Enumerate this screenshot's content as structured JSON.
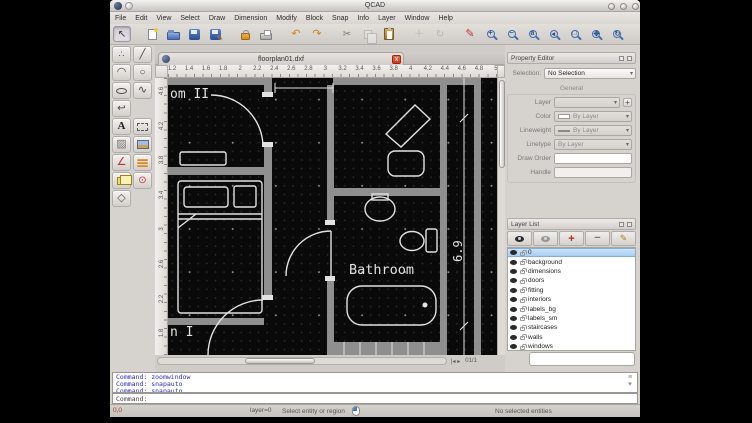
{
  "window": {
    "title": "QCAD"
  },
  "menu_bar": {
    "items": [
      "File",
      "Edit",
      "View",
      "Select",
      "Draw",
      "Dimension",
      "Modify",
      "Block",
      "Snap",
      "Info",
      "Layer",
      "Window",
      "Help"
    ]
  },
  "toolbar": {
    "buttons": [
      {
        "icon": "select-pointer",
        "pressed": true
      },
      {
        "icon": "sep"
      },
      {
        "icon": "new-file"
      },
      {
        "icon": "open-file"
      },
      {
        "icon": "save"
      },
      {
        "icon": "save-as"
      },
      {
        "icon": "sep"
      },
      {
        "icon": "secure-lock"
      },
      {
        "icon": "print"
      },
      {
        "icon": "sep"
      },
      {
        "icon": "undo"
      },
      {
        "icon": "redo"
      },
      {
        "icon": "sep"
      },
      {
        "icon": "cut"
      },
      {
        "icon": "copy",
        "disabled": true
      },
      {
        "icon": "paste"
      },
      {
        "icon": "sep"
      },
      {
        "icon": "move",
        "disabled": true
      },
      {
        "icon": "rotate",
        "disabled": true
      },
      {
        "icon": "sep"
      },
      {
        "icon": "pen-edit"
      },
      {
        "icon": "zoom-in"
      },
      {
        "icon": "zoom-out"
      },
      {
        "icon": "zoom-auto"
      },
      {
        "icon": "zoom-prev"
      },
      {
        "icon": "zoom-window"
      },
      {
        "icon": "zoom-pan"
      },
      {
        "icon": "zoom-refresh"
      }
    ]
  },
  "tool_palette": {
    "rows": [
      [
        "point-tool",
        "line-tool"
      ],
      [
        "arc-tool",
        "circle-tool"
      ],
      [
        "ellipse-tool",
        "spline-tool"
      ],
      [
        "polyline-tool"
      ],
      [
        "text-tool",
        "dimension-tool"
      ],
      [
        "hatch-tool",
        "image-tool"
      ],
      [
        "dimension-aligned-tool",
        "draw-order-tool"
      ],
      [
        "block-tool",
        "snap-tool"
      ],
      [
        "solid-tool"
      ]
    ]
  },
  "mdi": {
    "tab_title": "floorplan01.dxf",
    "close_glyph": "x",
    "page_indicator": "01/1"
  },
  "rulers": {
    "horizontal": [
      "1.2",
      "1.4",
      "1.6",
      "1.8",
      "2",
      "2.2",
      "2.4",
      "2.6",
      "2.8",
      "3",
      "3.2",
      "3.4",
      "3.6",
      "3.8",
      "4",
      "4.2",
      "4.4",
      "4.6",
      "4.8",
      "5"
    ],
    "vertical": [
      "4.6",
      "4.2",
      "3.8",
      "3.4",
      "3",
      "2.6",
      "2.2",
      "1.8"
    ]
  },
  "canvas": {
    "labels": {
      "room2_partial": "om II",
      "room1_partial": "n I",
      "bathroom": "Bathroom",
      "dimension": "6.9"
    }
  },
  "property_editor": {
    "title": "Property Editor",
    "selection_label": "Selection:",
    "selection_value": "No Selection",
    "group_general": "General",
    "layer_label": "Layer",
    "color_label": "Color",
    "color_value": "By Layer",
    "lineweight_label": "Lineweight",
    "lineweight_value": "By Layer",
    "linetype_label": "Linetype",
    "linetype_value": "By Layer",
    "draw_order_label": "Draw Order",
    "handle_label": "Handle",
    "add_layer_plus": "+"
  },
  "layer_list": {
    "title": "Layer List",
    "toolbar_icons": [
      "show-all-layers",
      "hide-all-layers",
      "add-layer",
      "remove-layer",
      "edit-layer"
    ],
    "layers": [
      "0",
      "background",
      "dimensions",
      "doors",
      "fitting",
      "interiors",
      "labels_bg",
      "labels_sm",
      "staircases",
      "walls",
      "windows"
    ],
    "selected_index": 0
  },
  "command": {
    "history": [
      "Command: zoomwindow",
      "Command: snapauto",
      "Command: snapauto"
    ],
    "prompt": "Command:"
  },
  "status_bar": {
    "coordinates": "0,0",
    "layer_state": "layer=0",
    "hint": "Select entity or region",
    "selection_info": "No selected entities"
  },
  "colors": {
    "accent_blue": "#3f6db0",
    "canvas_bg": "#0a0a0a",
    "wall_gray": "#8f8f8f",
    "entity_white": "#e2e2e2",
    "command_blue": "#2a2ab8",
    "close_red": "#c83818"
  }
}
